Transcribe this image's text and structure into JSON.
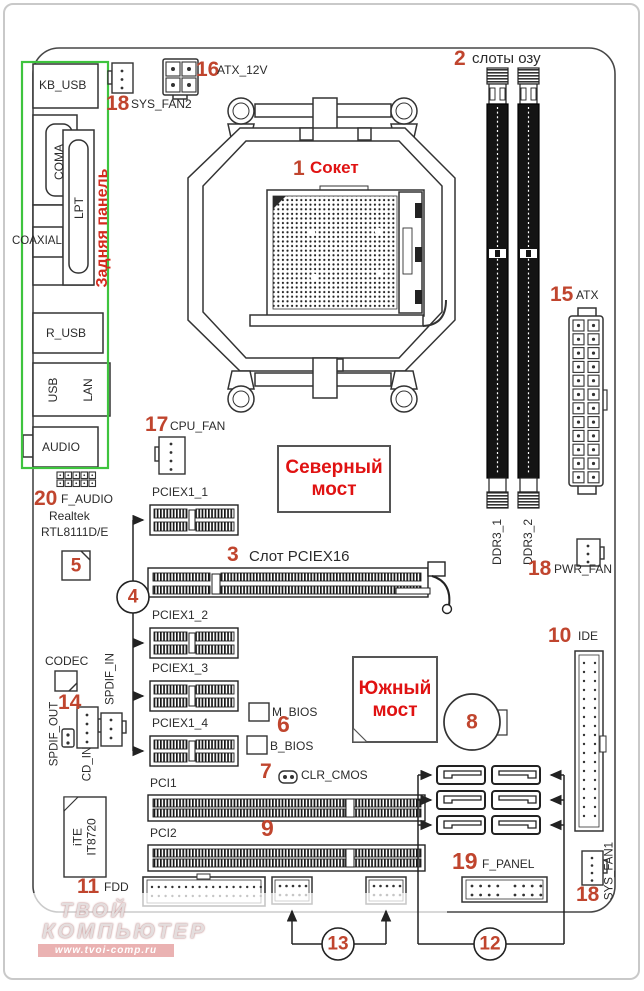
{
  "colors": {
    "callout_number": "#c0452e",
    "title_red": "#e01212",
    "back_panel_green": "#3ec43e"
  },
  "back_panel": {
    "title": "Задняя панель",
    "ports": {
      "kb_usb": "KB_USB",
      "coma": "COMA",
      "lpt": "LPT",
      "coaxial": "COAXIAL",
      "r_usb": "R_USB",
      "usb": "USB",
      "lan": "LAN",
      "audio": "AUDIO"
    }
  },
  "numbers": {
    "socket": "1",
    "ram": "2",
    "pciex16": "3",
    "pcie_x1_group": "4",
    "lan_chip": "5",
    "bios": "6",
    "clr_cmos": "7",
    "battery": "8",
    "pci": "9",
    "ide": "10",
    "fdd": "11",
    "sata_group": "12",
    "usb_headers": "13",
    "spdif": "14",
    "atx": "15",
    "atx_12v": "16",
    "cpu_fan": "17",
    "sys_fan2": "18",
    "pwr_fan": "18",
    "sys_fan1": "18",
    "f_panel": "19",
    "f_audio": "20"
  },
  "labels": {
    "socket": "Сокет",
    "ram": "слоты озу",
    "pciex16": "Слот PCIEX16",
    "pciex1_1": "PCIEX1_1",
    "pciex1_2": "PCIEX1_2",
    "pciex1_3": "PCIEX1_3",
    "pciex1_4": "PCIEX1_4",
    "ddr3_1": "DDR3_1",
    "ddr3_2": "DDR3_2",
    "atx": "ATX",
    "atx_12v": "ATX_12V",
    "cpu_fan": "CPU_FAN",
    "sys_fan2": "SYS_FAN2",
    "pwr_fan": "PWR_FAN",
    "sys_fan1": "SYS_FAN1",
    "f_audio": "F_AUDIO",
    "realtek_line1": "Realtek",
    "realtek_line2": "RTL8111D/E",
    "codec": "CODEC",
    "spdif_out": "SPDIF_OUT",
    "cd_in": "CD_IN",
    "spdif_in": "SPDIF_IN",
    "m_bios": "M_BIOS",
    "b_bios": "B_BIOS",
    "clr_cmos": "CLR_CMOS",
    "ide": "IDE",
    "pci1": "PCI1",
    "pci2": "PCI2",
    "fdd": "FDD",
    "f_panel": "F_PANEL"
  },
  "chips": {
    "north_line1": "Северный",
    "north_line2": "мост",
    "south_line1": "Южный",
    "south_line2": "мост",
    "ite_line1": "iTE",
    "ite_line2": "IT8720"
  },
  "watermark": {
    "line1": "ТВОЙ",
    "line2": "КОМПЬЮТЕР",
    "url": "www.tvoi-comp.ru"
  }
}
